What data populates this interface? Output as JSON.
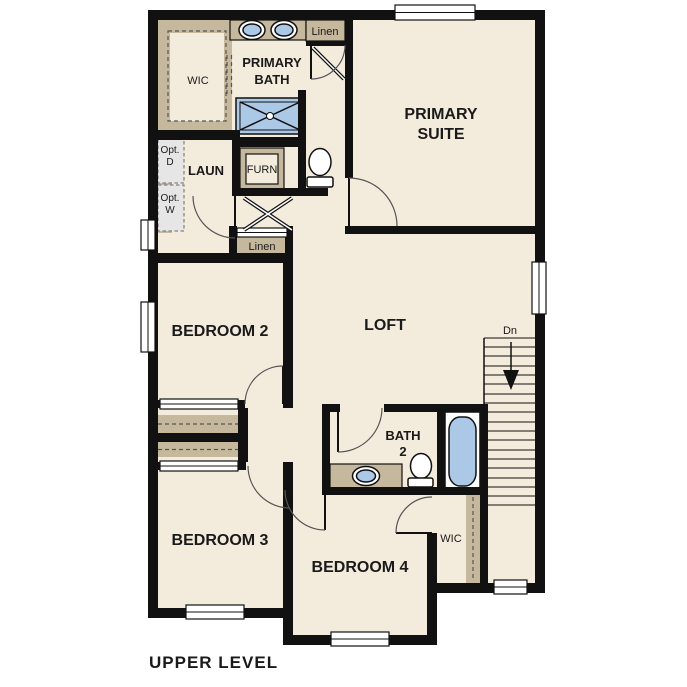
{
  "title": "UPPER LEVEL",
  "rooms": {
    "wic_top": "WIC",
    "primary_bath": {
      "line1": "PRIMARY",
      "line2": "BATH"
    },
    "linen_top": "Linen",
    "primary_suite": {
      "line1": "PRIMARY",
      "line2": "SUITE"
    },
    "laundry": "LAUN",
    "opt_dryer": {
      "line1": "Opt.",
      "line2": "D"
    },
    "opt_washer": {
      "line1": "Opt.",
      "line2": "W"
    },
    "furnace": "FURN",
    "linen_hall": "Linen",
    "bedroom2": "BEDROOM 2",
    "loft": "LOFT",
    "stairs_down": "Dn",
    "bath2": {
      "line1": "BATH",
      "line2": "2"
    },
    "bedroom3": "BEDROOM 3",
    "bedroom4": "BEDROOM 4",
    "wic_bedroom4": "WIC"
  },
  "colors": {
    "wall": "#111111",
    "floor": "#f3ebdc",
    "millwork_tan": "#c6b89c",
    "fixture_blue": "#abc9e6",
    "appliance_gray": "#e6e6e6",
    "background": "#ffffff"
  }
}
